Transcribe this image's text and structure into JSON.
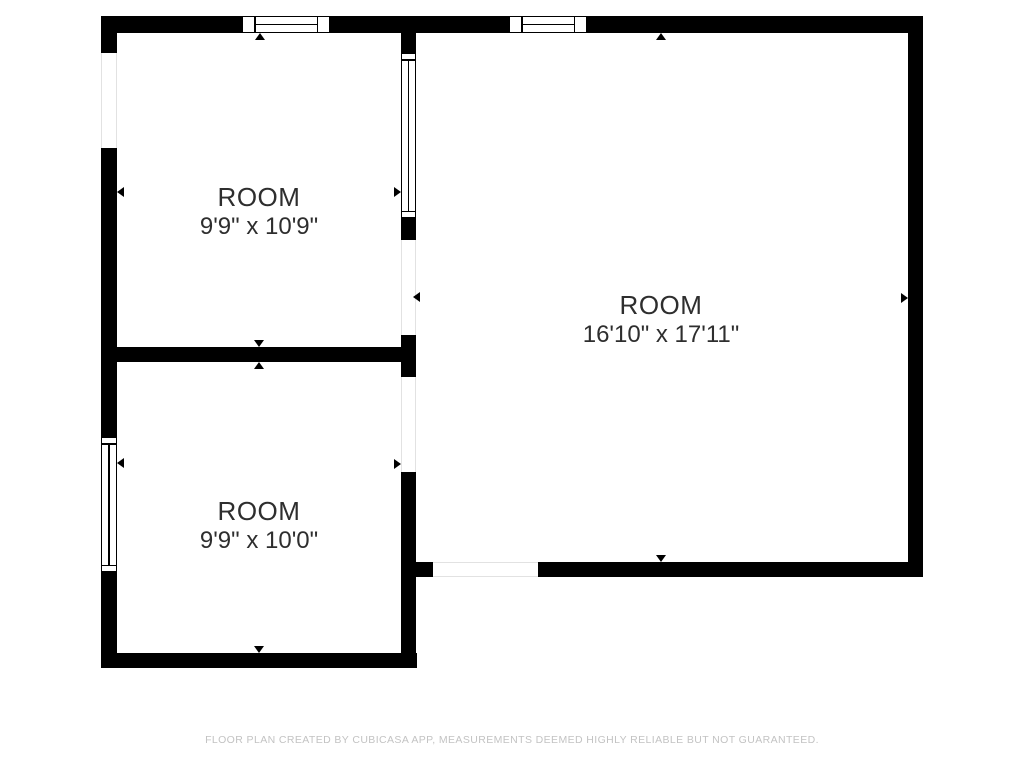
{
  "floorplan": {
    "colors": {
      "bg": "#ffffff",
      "wall": "#000000",
      "label": "#2e2e2e",
      "footer": "#c3c3c3",
      "openline": "#e2e2e2"
    },
    "rooms": [
      {
        "name": "ROOM",
        "dimensions": "9'9\" x 10'9\"",
        "label": {
          "x": 259,
          "y": 212
        }
      },
      {
        "name": "ROOM",
        "dimensions": "9'9\" x 10'0\"",
        "label": {
          "x": 259,
          "y": 526
        }
      },
      {
        "name": "ROOM",
        "dimensions": "16'10\" x 17'11\"",
        "label": {
          "x": 661,
          "y": 320
        }
      }
    ],
    "footer": {
      "text": "FLOOR PLAN CREATED BY CUBICASA APP, MEASUREMENTS DEEMED HIGHLY RELIABLE BUT NOT GUARANTEED."
    },
    "walls": [
      {
        "x": 101,
        "y": 16,
        "w": 141,
        "h": 17
      },
      {
        "x": 330,
        "y": 16,
        "w": 179,
        "h": 17
      },
      {
        "x": 587,
        "y": 16,
        "w": 336,
        "h": 17
      },
      {
        "x": 101,
        "y": 33,
        "w": 16,
        "h": 20
      },
      {
        "x": 101,
        "y": 148,
        "w": 16,
        "h": 289
      },
      {
        "x": 101,
        "y": 572,
        "w": 16,
        "h": 96
      },
      {
        "x": 101,
        "y": 653,
        "w": 316,
        "h": 15
      },
      {
        "x": 101,
        "y": 347,
        "w": 300,
        "h": 15
      },
      {
        "x": 401,
        "y": 33,
        "w": 15,
        "h": 20
      },
      {
        "x": 401,
        "y": 218,
        "w": 15,
        "h": 22
      },
      {
        "x": 401,
        "y": 335,
        "w": 15,
        "h": 42
      },
      {
        "x": 401,
        "y": 472,
        "w": 15,
        "h": 196
      },
      {
        "x": 416,
        "y": 562,
        "w": 17,
        "h": 15
      },
      {
        "x": 538,
        "y": 562,
        "w": 385,
        "h": 15
      },
      {
        "x": 908,
        "y": 16,
        "w": 15,
        "h": 561
      }
    ],
    "windows": [
      {
        "x": 242,
        "y": 16,
        "w": 88,
        "h": 17,
        "o": "h"
      },
      {
        "x": 509,
        "y": 16,
        "w": 78,
        "h": 17,
        "o": "h"
      },
      {
        "x": 401,
        "y": 53,
        "w": 15,
        "h": 165,
        "o": "v"
      },
      {
        "x": 101,
        "y": 437,
        "w": 16,
        "h": 135,
        "o": "v"
      }
    ],
    "openings": [
      {
        "x": 101,
        "y": 53,
        "w": 16,
        "h": 95,
        "o": "v"
      },
      {
        "x": 401,
        "y": 240,
        "w": 15,
        "h": 95,
        "o": "v"
      },
      {
        "x": 401,
        "y": 377,
        "w": 15,
        "h": 95,
        "o": "v"
      },
      {
        "x": 433,
        "y": 562,
        "w": 105,
        "h": 15,
        "o": "h"
      }
    ],
    "markers": [
      {
        "x": 260,
        "y": 33,
        "d": "up"
      },
      {
        "x": 117,
        "y": 192,
        "d": "left"
      },
      {
        "x": 401,
        "y": 192,
        "d": "right"
      },
      {
        "x": 661,
        "y": 33,
        "d": "up"
      },
      {
        "x": 908,
        "y": 298,
        "d": "right"
      },
      {
        "x": 259,
        "y": 347,
        "d": "down"
      },
      {
        "x": 259,
        "y": 362,
        "d": "up"
      },
      {
        "x": 413,
        "y": 297,
        "d": "left"
      },
      {
        "x": 401,
        "y": 464,
        "d": "right"
      },
      {
        "x": 117,
        "y": 463,
        "d": "left"
      },
      {
        "x": 661,
        "y": 562,
        "d": "down"
      },
      {
        "x": 259,
        "y": 653,
        "d": "down"
      }
    ]
  }
}
